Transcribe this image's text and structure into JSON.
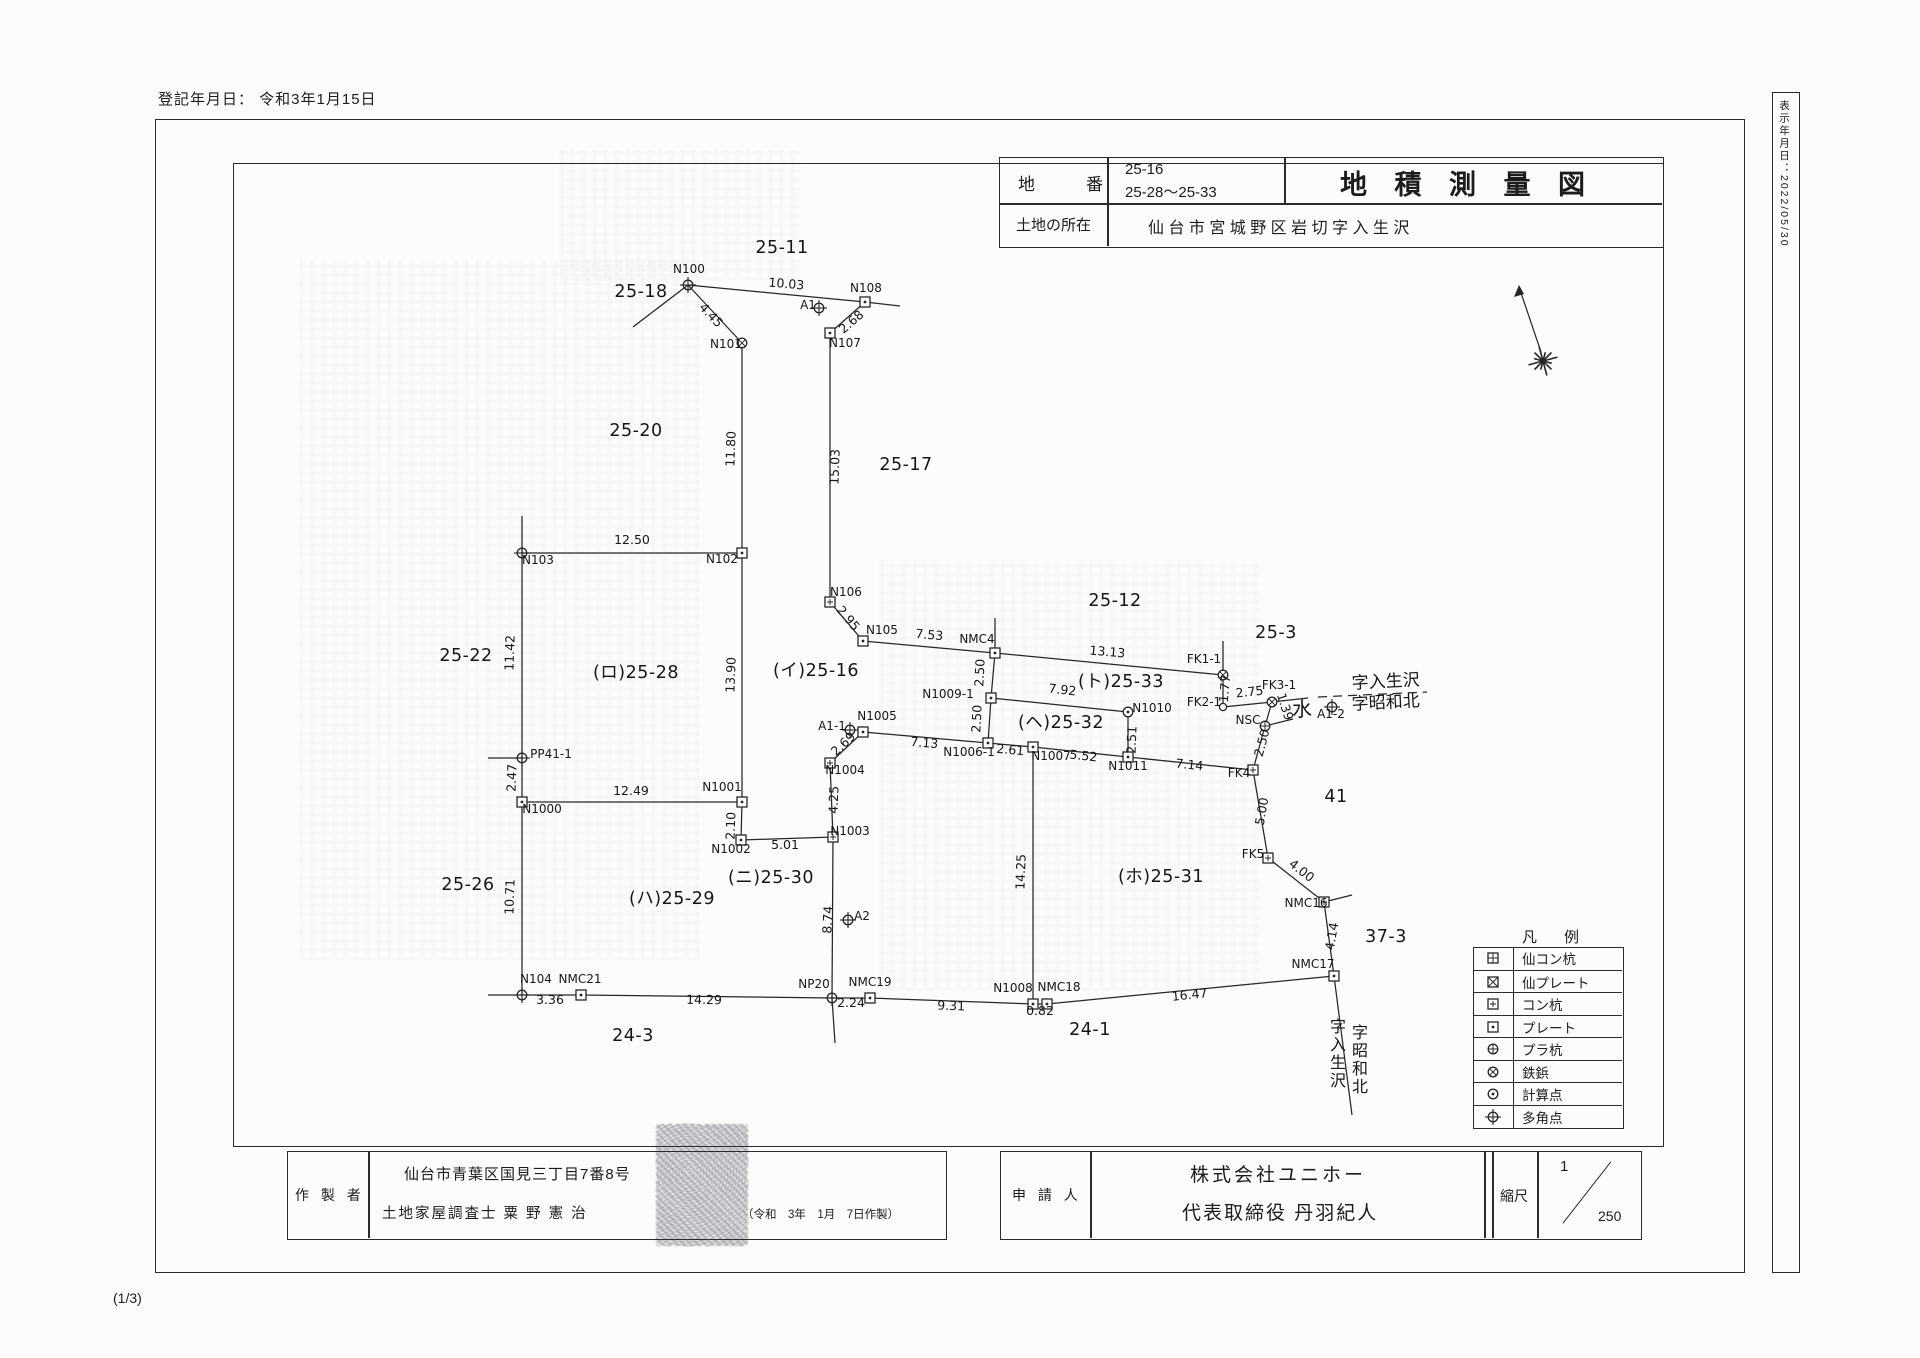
{
  "page": {
    "registration_date": "登記年月日： 令和3年1月15日",
    "side_date": "表示年月日：2022/05/30",
    "sheet_indicator": "(1/3)"
  },
  "title_block": {
    "parcel_label": "地　　　番",
    "parcel_numbers": [
      "25-16",
      "25-28〜25-33"
    ],
    "location_label": "土地の所在",
    "location_value": "仙 台 市 宮 城 野 区 岩 切 字 入 生 沢",
    "doc_title": "地 積 測 量 図"
  },
  "maker": {
    "label": "作 製 者",
    "address": "仙台市青葉区国見三丁目7番8号",
    "surveyor": "土地家屋調査士 粟 野 憲 治",
    "date_note": "（令和　3年　1月　7日作製）"
  },
  "applicant": {
    "label": "申 請 人",
    "company": "株式会社ユニホー",
    "representative": "代表取締役 丹羽紀人",
    "scale_label": "縮尺",
    "scale_numerator": "1",
    "scale_denominator": "250"
  },
  "legend": {
    "title": "凡　例",
    "items": [
      {
        "symbol": "sq-cross",
        "label": "仙コン杭"
      },
      {
        "symbol": "sq-x",
        "label": "仙プレート"
      },
      {
        "symbol": "sq-plus",
        "label": "コン杭"
      },
      {
        "symbol": "sq-dot",
        "label": "プレート"
      },
      {
        "symbol": "circle-plus",
        "label": "プラ杭"
      },
      {
        "symbol": "circle-x",
        "label": "鉄鋲"
      },
      {
        "symbol": "circle-dot",
        "label": "計算点"
      },
      {
        "symbol": "circle-cross",
        "label": "多角点"
      }
    ]
  },
  "map": {
    "segments": [
      [
        633,
        327,
        688,
        285
      ],
      [
        688,
        285,
        865,
        302
      ],
      [
        865,
        302,
        900,
        306
      ],
      [
        688,
        285,
        742,
        343
      ],
      [
        742,
        343,
        742,
        553
      ],
      [
        830,
        333,
        865,
        302
      ],
      [
        830,
        333,
        830,
        602
      ],
      [
        522,
        516,
        522,
        553
      ],
      [
        522,
        553,
        742,
        553
      ],
      [
        742,
        553,
        742,
        802
      ],
      [
        830,
        602,
        863,
        641
      ],
      [
        863,
        641,
        995,
        653
      ],
      [
        995,
        618,
        995,
        653
      ],
      [
        995,
        653,
        1223,
        675
      ],
      [
        1223,
        641,
        1223,
        675
      ],
      [
        1223,
        675,
        1223,
        707
      ],
      [
        1223,
        707,
        1272,
        702
      ],
      [
        1272,
        702,
        1308,
        698
      ],
      [
        1272,
        702,
        1265,
        726
      ],
      [
        1265,
        726,
        1293,
        719
      ],
      [
        1265,
        726,
        1253,
        770
      ],
      [
        995,
        653,
        991,
        698
      ],
      [
        991,
        698,
        988,
        743
      ],
      [
        991,
        698,
        1128,
        712
      ],
      [
        1128,
        712,
        1128,
        757
      ],
      [
        863,
        732,
        988,
        743
      ],
      [
        988,
        743,
        1033,
        747
      ],
      [
        1033,
        747,
        1128,
        757
      ],
      [
        1128,
        757,
        1253,
        770
      ],
      [
        1253,
        770,
        1268,
        858
      ],
      [
        1268,
        858,
        1324,
        902
      ],
      [
        1324,
        902,
        1352,
        895
      ],
      [
        1324,
        902,
        1334,
        976
      ],
      [
        1334,
        976,
        1352,
        1115
      ],
      [
        1334,
        976,
        1047,
        1004
      ],
      [
        1047,
        1004,
        1033,
        1004
      ],
      [
        1033,
        1004,
        870,
        998
      ],
      [
        870,
        998,
        832,
        998
      ],
      [
        832,
        998,
        581,
        995
      ],
      [
        581,
        995,
        522,
        995
      ],
      [
        488,
        995,
        522,
        995
      ],
      [
        522,
        553,
        522,
        995
      ],
      [
        488,
        758,
        522,
        758
      ],
      [
        522,
        802,
        742,
        802
      ],
      [
        742,
        802,
        741,
        840
      ],
      [
        741,
        840,
        833,
        837
      ],
      [
        833,
        837,
        830,
        763
      ],
      [
        830,
        763,
        863,
        732
      ],
      [
        833,
        837,
        832,
        998
      ],
      [
        832,
        998,
        835,
        1043
      ],
      [
        1033,
        747,
        1033,
        1004
      ]
    ],
    "dashed_segments": [
      [
        1318,
        697,
        1427,
        692
      ]
    ],
    "points": [
      {
        "id": "N100",
        "x": 688,
        "y": 285,
        "t": "circle-cross"
      },
      {
        "id": "N101",
        "x": 742,
        "y": 343,
        "t": "circle-x"
      },
      {
        "id": "N108",
        "x": 865,
        "y": 302,
        "t": "sq-dot"
      },
      {
        "id": "N107",
        "x": 830,
        "y": 333,
        "t": "sq-dot"
      },
      {
        "id": "A1",
        "x": 819,
        "y": 308,
        "t": "circle-cross"
      },
      {
        "id": "N103",
        "x": 522,
        "y": 553,
        "t": "circle-cross"
      },
      {
        "id": "N102",
        "x": 742,
        "y": 553,
        "t": "sq-dot"
      },
      {
        "id": "N106",
        "x": 830,
        "y": 602,
        "t": "sq-plus"
      },
      {
        "id": "N105",
        "x": 863,
        "y": 641,
        "t": "sq-dot"
      },
      {
        "id": "NMC4",
        "x": 995,
        "y": 653,
        "t": "sq-dot"
      },
      {
        "id": "FK1-1",
        "x": 1223,
        "y": 675,
        "t": "circle-x"
      },
      {
        "id": "FK2-1",
        "x": 1223,
        "y": 707,
        "t": "circle"
      },
      {
        "id": "FK3-1",
        "x": 1272,
        "y": 702,
        "t": "circle-x"
      },
      {
        "id": "NSC",
        "x": 1265,
        "y": 726,
        "t": "circle-plus"
      },
      {
        "id": "A1-2",
        "x": 1332,
        "y": 707,
        "t": "circle-cross"
      },
      {
        "id": "N1010",
        "x": 1128,
        "y": 712,
        "t": "circle-dot"
      },
      {
        "id": "N1009-1",
        "x": 991,
        "y": 698,
        "t": "sq-dot"
      },
      {
        "id": "N1006-1",
        "x": 988,
        "y": 743,
        "t": "sq-dot"
      },
      {
        "id": "N1007",
        "x": 1033,
        "y": 747,
        "t": "sq-dot"
      },
      {
        "id": "N1011",
        "x": 1128,
        "y": 757,
        "t": "sq-dot"
      },
      {
        "id": "FK4",
        "x": 1253,
        "y": 770,
        "t": "sq-plus"
      },
      {
        "id": "FK5",
        "x": 1268,
        "y": 858,
        "t": "sq-plus"
      },
      {
        "id": "NMC16",
        "x": 1324,
        "y": 902,
        "t": "sq-plus"
      },
      {
        "id": "NMC17",
        "x": 1334,
        "y": 976,
        "t": "sq-dot"
      },
      {
        "id": "NMC18",
        "x": 1047,
        "y": 1004,
        "t": "sq-dot"
      },
      {
        "id": "N1008",
        "x": 1033,
        "y": 1004,
        "t": "sq-dot"
      },
      {
        "id": "NMC19",
        "x": 870,
        "y": 998,
        "t": "sq-dot"
      },
      {
        "id": "NP20",
        "x": 832,
        "y": 998,
        "t": "circle-cross"
      },
      {
        "id": "NMC21",
        "x": 581,
        "y": 995,
        "t": "sq-dot"
      },
      {
        "id": "N104",
        "x": 522,
        "y": 995,
        "t": "circle-cross"
      },
      {
        "id": "N1000",
        "x": 522,
        "y": 802,
        "t": "sq-dot"
      },
      {
        "id": "PP41-1",
        "x": 522,
        "y": 758,
        "t": "circle-cross"
      },
      {
        "id": "N1001",
        "x": 742,
        "y": 802,
        "t": "sq-dot"
      },
      {
        "id": "N1002",
        "x": 741,
        "y": 840,
        "t": "sq-dot"
      },
      {
        "id": "N1003",
        "x": 833,
        "y": 837,
        "t": "sq-plus"
      },
      {
        "id": "N1004",
        "x": 830,
        "y": 763,
        "t": "sq-plus"
      },
      {
        "id": "N1005",
        "x": 863,
        "y": 732,
        "t": "sq-dot"
      },
      {
        "id": "A1-1",
        "x": 850,
        "y": 730,
        "t": "circle-cross"
      },
      {
        "id": "A2",
        "x": 848,
        "y": 920,
        "t": "circle-cross"
      }
    ],
    "point_labels": [
      [
        "N100",
        689,
        273
      ],
      [
        "N101",
        726,
        348
      ],
      [
        "N108",
        866,
        292
      ],
      [
        "N107",
        845,
        347
      ],
      [
        "A1",
        808,
        309
      ],
      [
        "N103",
        538,
        564
      ],
      [
        "N102",
        722,
        563
      ],
      [
        "N106",
        846,
        596
      ],
      [
        "N105",
        882,
        634
      ],
      [
        "NMC4",
        977,
        643
      ],
      [
        "FK1-1",
        1204,
        663
      ],
      [
        "FK2-1",
        1204,
        706
      ],
      [
        "FK3-1",
        1279,
        689
      ],
      [
        "NSC",
        1248,
        724
      ],
      [
        "A1-2",
        1331,
        718
      ],
      [
        "N1010",
        1152,
        712
      ],
      [
        "N1009-1",
        948,
        698
      ],
      [
        "N1006-1",
        969,
        756
      ],
      [
        "N1007",
        1051,
        760
      ],
      [
        "N1011",
        1128,
        770
      ],
      [
        "FK4",
        1239,
        777
      ],
      [
        "FK5",
        1253,
        858
      ],
      [
        "NMC16",
        1306,
        907
      ],
      [
        "NMC17",
        1313,
        968
      ],
      [
        "NMC18",
        1059,
        991
      ],
      [
        "N1008",
        1013,
        992
      ],
      [
        "NMC19",
        870,
        986
      ],
      [
        "NP20",
        814,
        988
      ],
      [
        "NMC21",
        580,
        983
      ],
      [
        "N104",
        536,
        983
      ],
      [
        "N1000",
        542,
        813
      ],
      [
        "PP41-1",
        551,
        758
      ],
      [
        "N1001",
        722,
        791
      ],
      [
        "N1002",
        731,
        853
      ],
      [
        "N1003",
        850,
        835
      ],
      [
        "N1004",
        845,
        774
      ],
      [
        "N1005",
        877,
        720
      ],
      [
        "A1-1",
        832,
        730
      ],
      [
        "A2",
        862,
        920
      ]
    ],
    "measure_labels": [
      [
        "10.03",
        786,
        288,
        5
      ],
      [
        "4.45",
        708,
        318,
        47
      ],
      [
        "2.68",
        854,
        325,
        -41
      ],
      [
        "11.80",
        735,
        449,
        -88
      ],
      [
        "15.03",
        839,
        467,
        -88
      ],
      [
        "12.50",
        632,
        544,
        0
      ],
      [
        "13.90",
        735,
        675,
        -88
      ],
      [
        "2.95",
        845,
        621,
        50
      ],
      [
        "7.53",
        929,
        639,
        5
      ],
      [
        "13.13",
        1107,
        656,
        5
      ],
      [
        "1.77",
        1229,
        689,
        -85
      ],
      [
        "2.75",
        1250,
        696,
        -6
      ],
      [
        "1.39",
        1281,
        708,
        72
      ],
      [
        "2.50",
        984,
        673,
        -87
      ],
      [
        "2.50",
        981,
        719,
        -87
      ],
      [
        "7.92",
        1062,
        694,
        6
      ],
      [
        "2.51",
        1136,
        740,
        -88
      ],
      [
        "7.13",
        924,
        747,
        5
      ],
      [
        "2.61",
        1010,
        754,
        5
      ],
      [
        "5.52",
        1083,
        760,
        6
      ],
      [
        "7.14",
        1189,
        769,
        6
      ],
      [
        "2.50",
        1266,
        744,
        -75
      ],
      [
        "5.00",
        1266,
        812,
        -80
      ],
      [
        "4.00",
        1299,
        874,
        38
      ],
      [
        "4.14",
        1336,
        937,
        -80
      ],
      [
        "16.47",
        1190,
        999,
        -6
      ],
      [
        "0.82",
        1040,
        1015,
        0
      ],
      [
        "9.31",
        951,
        1010,
        2
      ],
      [
        "2.24",
        851,
        1007,
        0
      ],
      [
        "14.29",
        704,
        1004,
        1
      ],
      [
        "3.36",
        550,
        1004,
        0
      ],
      [
        "10.71",
        514,
        897,
        -88
      ],
      [
        "2.47",
        516,
        778,
        -88
      ],
      [
        "11.42",
        514,
        653,
        -88
      ],
      [
        "12.49",
        631,
        795,
        0
      ],
      [
        "2.10",
        735,
        826,
        -88
      ],
      [
        "5.01",
        785,
        849,
        0
      ],
      [
        "4.25",
        838,
        800,
        -88
      ],
      [
        "2.69",
        846,
        747,
        -43
      ],
      [
        "8.74",
        832,
        920,
        -87
      ],
      [
        "14.25",
        1025,
        872,
        -88
      ]
    ],
    "parcel_labels": [
      [
        "25-11",
        782,
        253
      ],
      [
        "25-18",
        641,
        297
      ],
      [
        "25-20",
        636,
        436
      ],
      [
        "25-17",
        906,
        470
      ],
      [
        "25-22",
        466,
        661
      ],
      [
        "(ロ)25-28",
        636,
        678
      ],
      [
        "(イ)25-16",
        816,
        676
      ],
      [
        "25-12",
        1115,
        606
      ],
      [
        "25-3",
        1276,
        638
      ],
      [
        "(ト)25-33",
        1121,
        687
      ],
      [
        "(ヘ)25-32",
        1061,
        728
      ],
      [
        "(ニ)25-30",
        771,
        883
      ],
      [
        "(ホ)25-31",
        1161,
        882
      ],
      [
        "25-26",
        468,
        890
      ],
      [
        "(ハ)25-29",
        672,
        904
      ],
      [
        "41",
        1336,
        802
      ],
      [
        "37-3",
        1386,
        942
      ],
      [
        "24-3",
        633,
        1041
      ],
      [
        "24-1",
        1090,
        1035
      ]
    ],
    "area_texts": [
      {
        "text": "水",
        "x": 1302,
        "y": 716,
        "size": 20,
        "rot": 0
      },
      {
        "text": "字入生沢",
        "x": 1386,
        "y": 687,
        "size": 17,
        "rot": -3
      },
      {
        "text": "字昭和北",
        "x": 1386,
        "y": 708,
        "size": 17,
        "rot": -3
      }
    ],
    "vertical_texts": [
      {
        "text": "字入生沢",
        "x": 1338,
        "y": 1032,
        "size": 16
      },
      {
        "text": "字昭和北",
        "x": 1360,
        "y": 1038,
        "size": 16
      }
    ]
  }
}
